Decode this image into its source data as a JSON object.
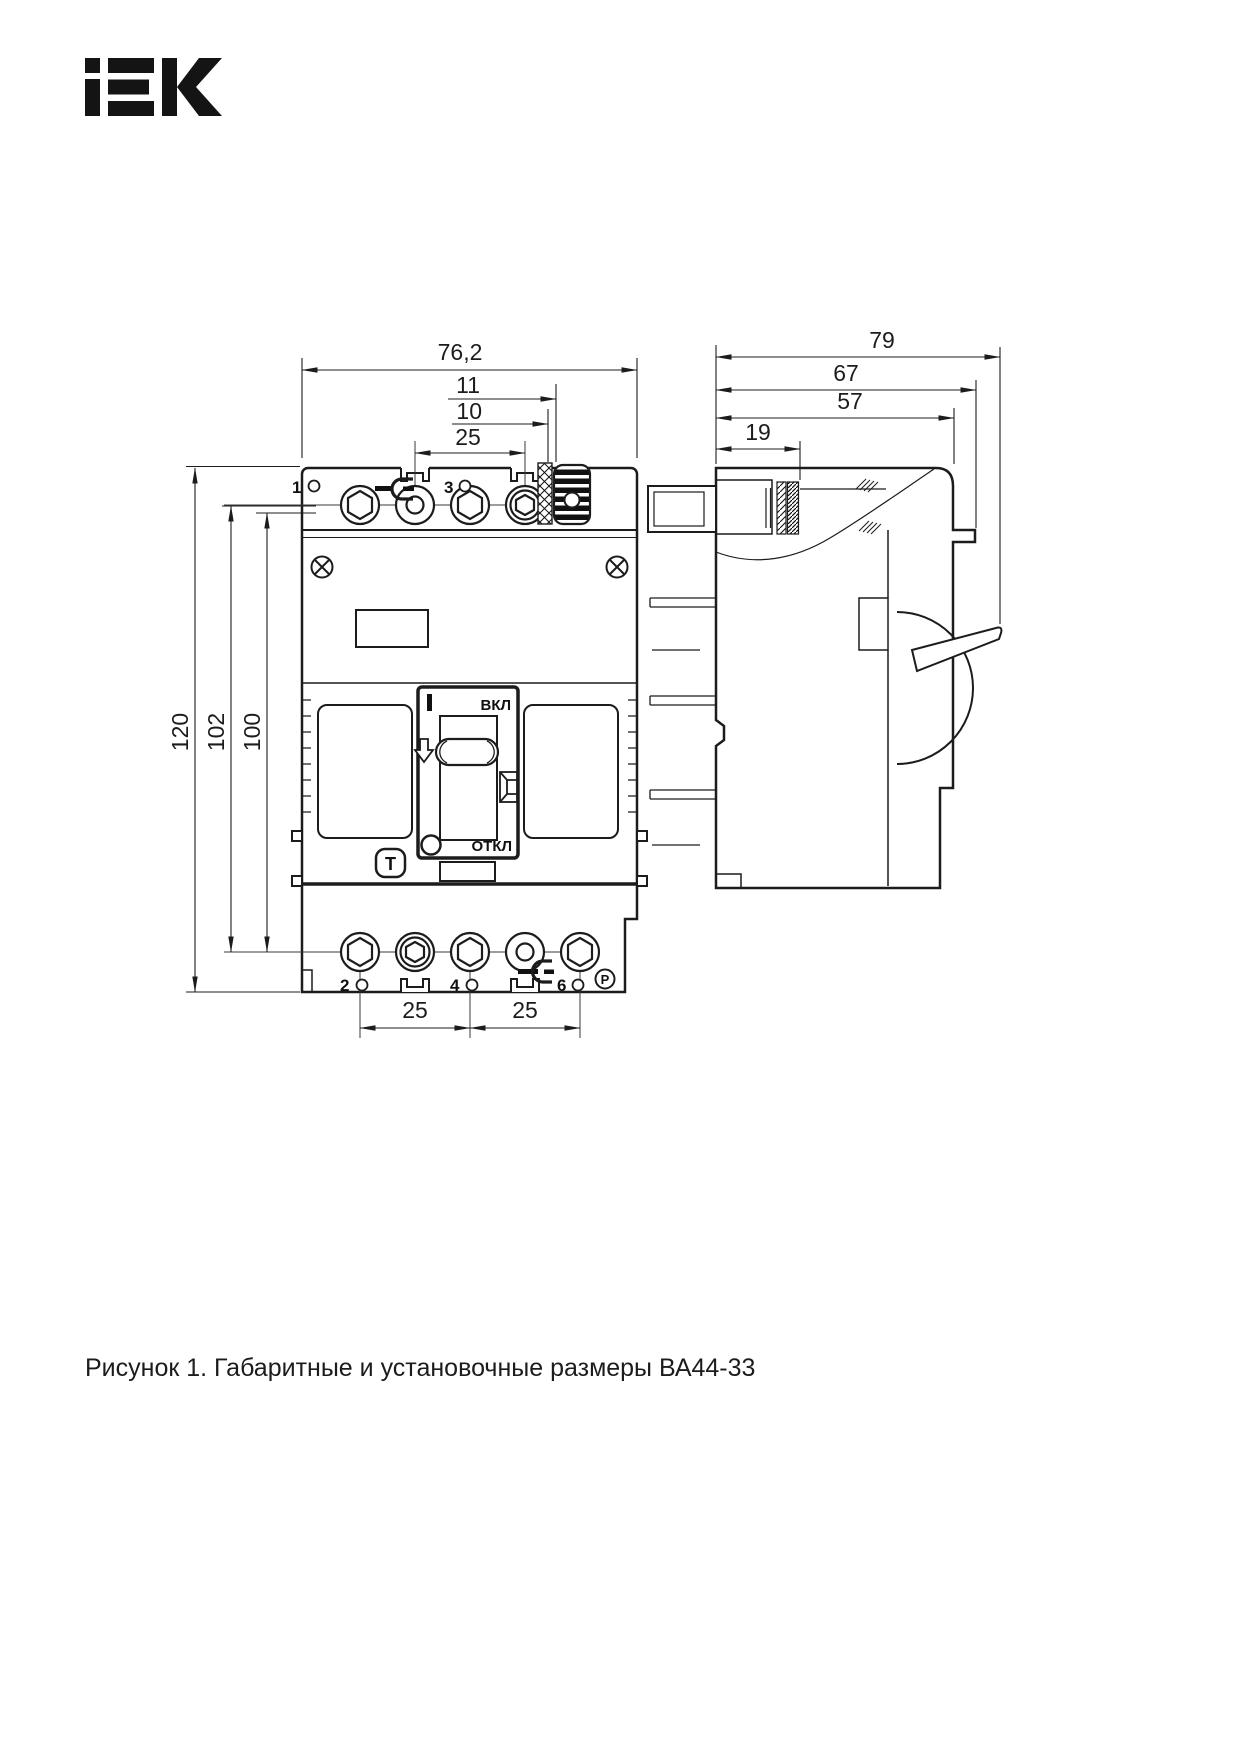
{
  "logo": {
    "text": "iEK"
  },
  "caption": "Рисунок 1. Габаритные и установочные размеры ВА44-33",
  "front_view": {
    "dims": {
      "width": "76,2",
      "d11": "11",
      "d10": "10",
      "pitch_top": "25",
      "height_total": "120",
      "height_102": "102",
      "height_100": "100",
      "pitch_bottom_1": "25",
      "pitch_bottom_2": "25"
    },
    "labels": {
      "on": "ВКЛ",
      "off": "ОТКЛ",
      "terminal_1": "1",
      "terminal_3": "3",
      "terminal_2": "2",
      "terminal_4": "4",
      "terminal_6": "6",
      "pole_p": "P",
      "test_t": "T"
    }
  },
  "side_view": {
    "dims": {
      "d79": "79",
      "d67": "67",
      "d57": "57",
      "d19": "19"
    }
  }
}
